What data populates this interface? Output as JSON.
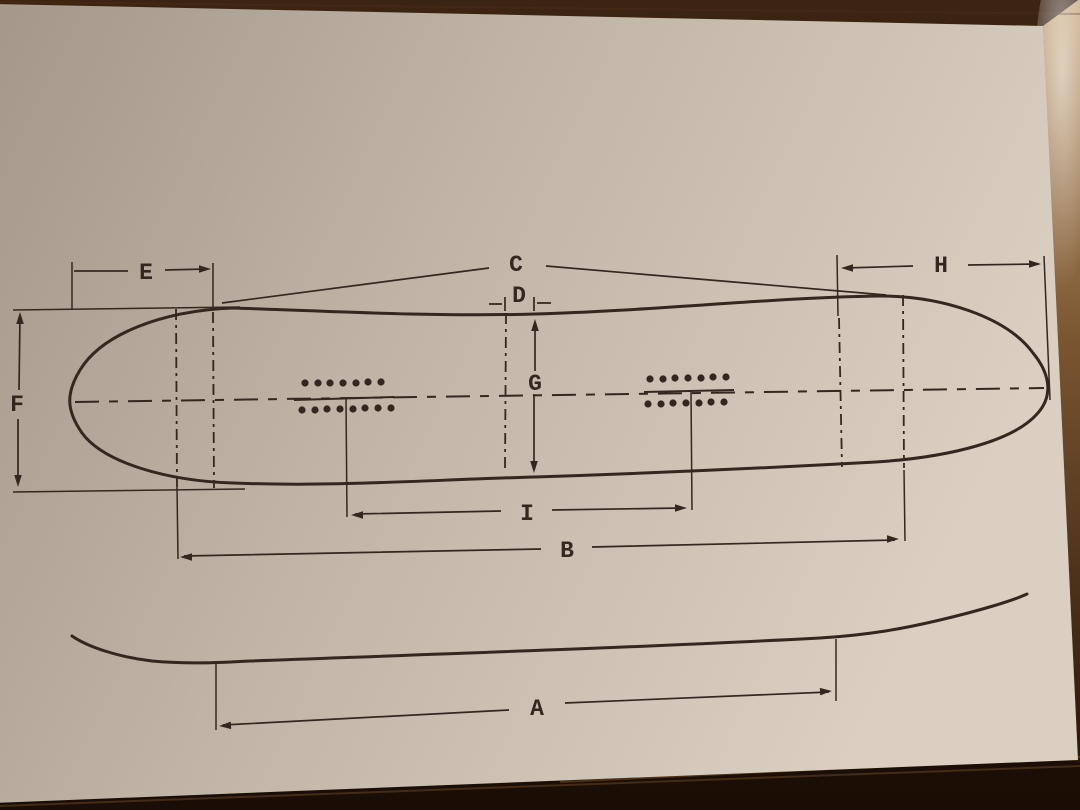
{
  "labels": {
    "A": "A",
    "B": "B",
    "C": "C",
    "D": "D",
    "E": "E",
    "F": "F",
    "G": "G",
    "H": "H",
    "I": "I"
  },
  "colors": {
    "ink": "#32281f",
    "paper-light": "#dacfc1",
    "paper-mid": "#bfb4a5",
    "paper-dark": "#a3988a",
    "wood-dark": "#201208",
    "wood-mid": "#3c2413",
    "wood-light": "#8a6642",
    "wood-sheen": "#d9c2a2"
  }
}
